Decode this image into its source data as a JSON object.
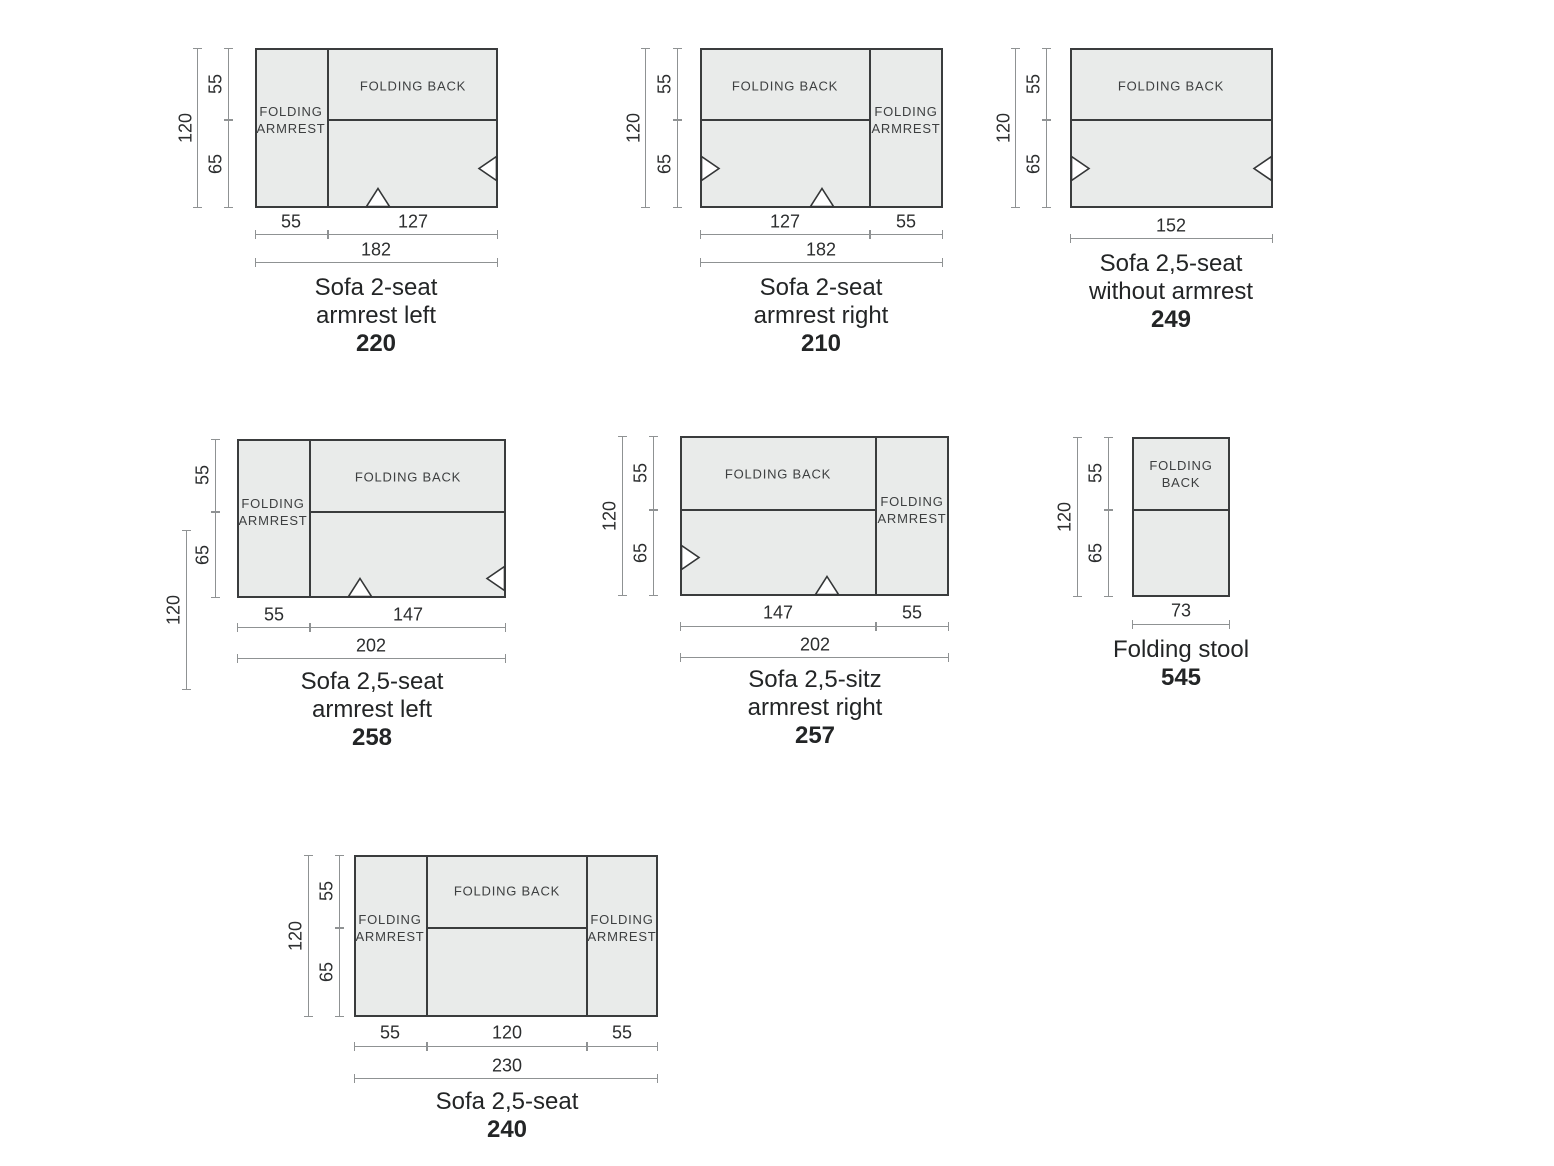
{
  "sheet": {
    "background": "#ffffff"
  },
  "colors": {
    "piece_fill": "#e9ebea",
    "piece_border": "#3a3c3d",
    "dimension_line": "#8f9293",
    "text": "#232526"
  },
  "diagrams": {
    "sofa_220": {
      "title": [
        "Sofa 2-seat",
        "armrest left"
      ],
      "code": "220",
      "back_label": "FOLDING BACK",
      "armrest_label": "FOLDING ARMREST",
      "dims": {
        "total_height": "120",
        "back_depth": "55",
        "seat_depth": "65",
        "armrest_width": "55",
        "seat_width": "127",
        "total_width": "182"
      }
    },
    "sofa_210": {
      "title": [
        "Sofa 2-seat",
        "armrest right"
      ],
      "code": "210",
      "back_label": "FOLDING BACK",
      "armrest_label": "FOLDING ARMREST",
      "dims": {
        "total_height": "120",
        "back_depth": "55",
        "seat_depth": "65",
        "seat_width": "127",
        "armrest_width": "55",
        "total_width": "182"
      }
    },
    "sofa_249": {
      "title": [
        "Sofa 2,5-seat",
        "without armrest"
      ],
      "code": "249",
      "back_label": "FOLDING BACK",
      "dims": {
        "total_height": "120",
        "back_depth": "55",
        "seat_depth": "65",
        "total_width": "152"
      }
    },
    "sofa_258": {
      "title": [
        "Sofa 2,5-seat",
        "armrest left"
      ],
      "code": "258",
      "back_label": "FOLDING BACK",
      "armrest_label": "FOLDING ARMREST",
      "dims": {
        "total_height": "120",
        "back_depth": "55",
        "seat_depth": "65",
        "armrest_width": "55",
        "seat_width": "147",
        "total_width": "202"
      }
    },
    "sofa_257": {
      "title": [
        "Sofa 2,5-sitz",
        "armrest right"
      ],
      "code": "257",
      "back_label": "FOLDING BACK",
      "armrest_label": "FOLDING ARMREST",
      "dims": {
        "total_height": "120",
        "back_depth": "55",
        "seat_depth": "65",
        "seat_width": "147",
        "armrest_width": "55",
        "total_width": "202"
      }
    },
    "stool_545": {
      "title": [
        "Folding stool"
      ],
      "code": "545",
      "back_label": "FOLDING BACK",
      "dims": {
        "total_height": "120",
        "back_depth": "55",
        "seat_depth": "65",
        "total_width": "73"
      }
    },
    "sofa_240": {
      "title": [
        "Sofa 2,5-seat"
      ],
      "code": "240",
      "back_label": "FOLDING BACK",
      "armrest_left_label": "FOLDING ARMREST",
      "armrest_right_label": "FOLDING ARMREST",
      "dims": {
        "total_height": "120",
        "back_depth": "55",
        "seat_depth": "65",
        "armrest_left_width": "55",
        "seat_width": "120",
        "armrest_right_width": "55",
        "total_width": "230"
      }
    }
  }
}
